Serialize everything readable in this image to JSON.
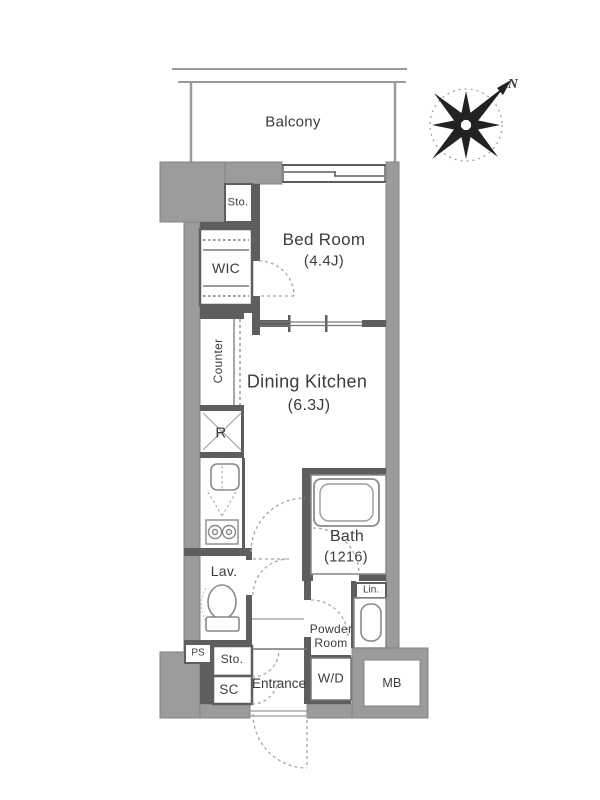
{
  "plan": {
    "balcony": "Balcony",
    "bedroom": {
      "name": "Bed Room",
      "size": "(4.4J)"
    },
    "dining_kitchen": {
      "name": "Dining Kitchen",
      "size": "(6.3J)"
    },
    "bath": {
      "name": "Bath",
      "size": "(1216)"
    },
    "wic": "WIC",
    "storage_top": "Sto.",
    "counter": "Counter",
    "refrigerator_space": "R",
    "lavatory": "Lav.",
    "linen": "Lin.",
    "powder_room": "Powder Room",
    "washer_dryer": "W/D",
    "pipe_space": "PS",
    "storage_bottom": "Sto.",
    "shoe_closet": "SC",
    "entrance": "Entrance",
    "meter_box": "MB",
    "compass_north": "N"
  },
  "colors": {
    "wall_exterior": "#9b9b9b",
    "wall_interior": "#5e5e5e",
    "fixture_stroke": "#8a8a8a",
    "door_dash": "#a5a5a5",
    "text": "#3c3c3c"
  }
}
